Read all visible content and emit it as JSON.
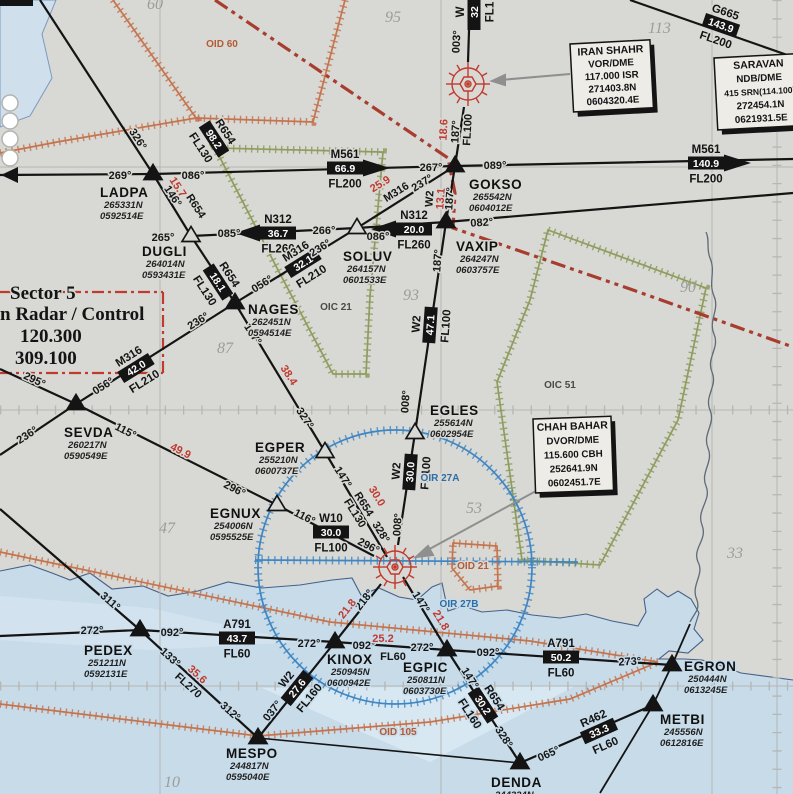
{
  "colors": {
    "land": "#d8d8d4",
    "sea": "#c7dbe9",
    "coast": "#46608c",
    "graticule": "#b6b6b2",
    "ink": "#141414",
    "red": "#c13a2e",
    "boundary_red": "#a83c2e",
    "danger_orange": "#c4744e",
    "area_green": "#8e9c5e",
    "ctr_blue": "#3f86c2",
    "label_blue": "#2e6da4",
    "gray_number": "#9c9c98",
    "pointer_gray": "#8f8f8f"
  },
  "sector_panel": {
    "line1": "Sector 5",
    "line2": "n Radar / Control",
    "freq1": "120.300",
    "freq2": "309.100"
  },
  "navaid_boxes": [
    {
      "id": "iran-shahr",
      "x": 570,
      "y": 44,
      "w": 80,
      "h": 68,
      "rot": -3,
      "lines": [
        "IRAN SHAHR",
        "VOR/DME",
        "117.000 ISR",
        "271403.8N",
        "0604320.4E"
      ]
    },
    {
      "id": "saravan",
      "x": 714,
      "y": 58,
      "w": 88,
      "h": 72,
      "rot": -3,
      "lines": [
        "SARAVAN",
        "NDB/DME",
        "415 SRN(114.100)",
        "272454.1N",
        "0621931.5E"
      ]
    },
    {
      "id": "chah-bahar",
      "x": 533,
      "y": 419,
      "w": 78,
      "h": 74,
      "rot": -2,
      "lines": [
        "CHAH BAHAR",
        "DVOR/DME",
        "115.600 CBH",
        "252641.9N",
        "0602451.7E"
      ]
    }
  ],
  "waypoints": [
    {
      "name": "LADPA",
      "lat": "265331N",
      "lon": "0592514E",
      "x": 153,
      "y": 174,
      "filled": true,
      "lx": 100,
      "ly": 197
    },
    {
      "name": "DUGLI",
      "lat": "264014N",
      "lon": "0593431E",
      "x": 191,
      "y": 236,
      "filled": false,
      "lx": 142,
      "ly": 256
    },
    {
      "name": "SOLUV",
      "lat": "264157N",
      "lon": "0601533E",
      "x": 357,
      "y": 228,
      "filled": false,
      "lx": 343,
      "ly": 261
    },
    {
      "name": "GOKSO",
      "lat": "265542N",
      "lon": "0604012E",
      "x": 455,
      "y": 166,
      "filled": true,
      "lx": 469,
      "ly": 189
    },
    {
      "name": "VAXIP",
      "lat": "264247N",
      "lon": "0603757E",
      "x": 446,
      "y": 222,
      "filled": true,
      "lx": 456,
      "ly": 251
    },
    {
      "name": "NAGES",
      "lat": "262451N",
      "lon": "0594514E",
      "x": 235,
      "y": 303,
      "filled": true,
      "lx": 248,
      "ly": 314
    },
    {
      "name": "SEVDA",
      "lat": "260217N",
      "lon": "0590549E",
      "x": 76,
      "y": 404,
      "filled": true,
      "lx": 64,
      "ly": 437
    },
    {
      "name": "EGLES",
      "lat": "255614N",
      "lon": "0602954E",
      "x": 415,
      "y": 433,
      "filled": false,
      "lx": 430,
      "ly": 415
    },
    {
      "name": "EGPER",
      "lat": "255210N",
      "lon": "0600737E",
      "x": 325,
      "y": 452,
      "filled": false,
      "lx": 255,
      "ly": 452
    },
    {
      "name": "EGNUX",
      "lat": "254006N",
      "lon": "0595525E",
      "x": 277,
      "y": 505,
      "filled": false,
      "lx": 210,
      "ly": 518
    },
    {
      "name": "PEDEX",
      "lat": "251211N",
      "lon": "0592131E",
      "x": 140,
      "y": 630,
      "filled": true,
      "lx": 84,
      "ly": 655
    },
    {
      "name": "KINOX",
      "lat": "250945N",
      "lon": "0600942E",
      "x": 335,
      "y": 642,
      "filled": true,
      "lx": 327,
      "ly": 664
    },
    {
      "name": "EGPIC",
      "lat": "250811N",
      "lon": "0603730E",
      "x": 447,
      "y": 650,
      "filled": true,
      "lx": 403,
      "ly": 672
    },
    {
      "name": "EGRON",
      "lat": "250444N",
      "lon": "0613245E",
      "x": 672,
      "y": 665,
      "filled": true,
      "lx": 684,
      "ly": 671
    },
    {
      "name": "METBI",
      "lat": "245556N",
      "lon": "0612816E",
      "x": 653,
      "y": 705,
      "filled": true,
      "lx": 660,
      "ly": 724
    },
    {
      "name": "MESPO",
      "lat": "244817N",
      "lon": "0595040E",
      "x": 258,
      "y": 738,
      "filled": true,
      "lx": 226,
      "ly": 758
    },
    {
      "name": "DENDA",
      "lat": "244324N",
      "lon": "",
      "x": 520,
      "y": 763,
      "filled": true,
      "lx": 491,
      "ly": 787
    }
  ],
  "airway_boxes": [
    {
      "awy": "M561",
      "dist": "66.9",
      "fl": "FL200",
      "x": 345,
      "y": 168,
      "rot": 0,
      "arrow": "right"
    },
    {
      "awy": "M561",
      "dist": "140.9",
      "fl": "FL200",
      "x": 706,
      "y": 163,
      "rot": 0,
      "arrow": "right"
    },
    {
      "awy": "G665",
      "dist": "143.9",
      "fl": "FL200",
      "x": 721,
      "y": 25,
      "rot": 19,
      "arrow": null
    },
    {
      "awy": "W",
      "dist": "32",
      "fl": "FL1",
      "x": 474,
      "y": 12,
      "rot": -90,
      "arrow": null
    },
    {
      "awy": "R654",
      "dist": "98.2",
      "fl": "FL130",
      "x": 214,
      "y": 139,
      "rot": 57,
      "arrow": null
    },
    {
      "awy": "R654",
      "dist": "18.1",
      "fl": "FL130",
      "x": 218,
      "y": 282,
      "rot": 57,
      "arrow": null
    },
    {
      "awy": "N312",
      "dist": "36.7",
      "fl": "FL260",
      "x": 278,
      "y": 233,
      "rot": 0,
      "arrow": "left"
    },
    {
      "awy": "M316",
      "dist": "32.1",
      "fl": "FL210",
      "x": 303,
      "y": 263,
      "rot": -32,
      "arrow": null
    },
    {
      "awy": "N312",
      "dist": "20.0",
      "fl": "FL260",
      "x": 414,
      "y": 229,
      "rot": 0,
      "arrow": "left"
    },
    {
      "awy": "M316",
      "dist": "42.0",
      "fl": "FL210",
      "x": 136,
      "y": 368,
      "rot": -32,
      "arrow": null
    },
    {
      "awy": "W2",
      "dist": "47.1",
      "fl": "FL100",
      "x": 430,
      "y": 325,
      "rot": -86,
      "arrow": null
    },
    {
      "awy": "W2",
      "dist": "30.0",
      "fl": "FL100",
      "x": 410,
      "y": 472,
      "rot": -86,
      "arrow": null
    },
    {
      "awy": "W10",
      "dist": "30.0",
      "fl": "FL100",
      "x": 331,
      "y": 532,
      "rot": 0,
      "arrow": null
    },
    {
      "awy": "W2",
      "dist": "27.6",
      "fl": "FL160",
      "x": 297,
      "y": 688,
      "rot": -51,
      "arrow": null
    },
    {
      "awy": "R654",
      "dist": "30.2",
      "fl": "FL160",
      "x": 483,
      "y": 705,
      "rot": 57,
      "arrow": null
    },
    {
      "awy": "A791",
      "dist": "43.7",
      "fl": "FL60",
      "x": 237,
      "y": 638,
      "rot": 0,
      "arrow": null
    },
    {
      "awy": "A791",
      "dist": "50.2",
      "fl": "FL60",
      "x": 561,
      "y": 657,
      "rot": 0,
      "arrow": null
    },
    {
      "awy": "R462",
      "dist": "33.3",
      "fl": "FL60",
      "x": 599,
      "y": 731,
      "rot": -24,
      "arrow": null
    }
  ],
  "bearing_labels": [
    {
      "t": "269°",
      "x": 120,
      "y": 179,
      "r": 0
    },
    {
      "t": "086°",
      "x": 193,
      "y": 179,
      "r": 0
    },
    {
      "t": "326°",
      "x": 135,
      "y": 141,
      "r": 57
    },
    {
      "t": "146°",
      "x": 170,
      "y": 198,
      "r": 57
    },
    {
      "t": "265°",
      "x": 163,
      "y": 241,
      "r": 0
    },
    {
      "t": "085°",
      "x": 229,
      "y": 237,
      "r": 0
    },
    {
      "t": "266°",
      "x": 324,
      "y": 234,
      "r": 0
    },
    {
      "t": "086°",
      "x": 378,
      "y": 240,
      "r": 0
    },
    {
      "t": "237°",
      "x": 424,
      "y": 186,
      "r": -32
    },
    {
      "t": "267°",
      "x": 431,
      "y": 171,
      "r": 0
    },
    {
      "t": "089°",
      "x": 495,
      "y": 169,
      "r": 0
    },
    {
      "t": "003°",
      "x": 460,
      "y": 42,
      "r": -87
    },
    {
      "t": "187°",
      "x": 459,
      "y": 132,
      "r": -87
    },
    {
      "t": "187°",
      "x": 453,
      "y": 199,
      "r": -86
    },
    {
      "t": "082°",
      "x": 482,
      "y": 226,
      "r": -4
    },
    {
      "t": "187°",
      "x": 441,
      "y": 261,
      "r": -86
    },
    {
      "t": "056°",
      "x": 264,
      "y": 287,
      "r": -32
    },
    {
      "t": "236°",
      "x": 322,
      "y": 251,
      "r": -32
    },
    {
      "t": "147°",
      "x": 250,
      "y": 336,
      "r": 57
    },
    {
      "t": "327°",
      "x": 302,
      "y": 420,
      "r": 57
    },
    {
      "t": "236°",
      "x": 200,
      "y": 324,
      "r": -32
    },
    {
      "t": "056°",
      "x": 105,
      "y": 389,
      "r": -32
    },
    {
      "t": "295°",
      "x": 33,
      "y": 383,
      "r": 25
    },
    {
      "t": "236°",
      "x": 29,
      "y": 438,
      "r": -33
    },
    {
      "t": "115°",
      "x": 124,
      "y": 434,
      "r": 27
    },
    {
      "t": "296°",
      "x": 233,
      "y": 492,
      "r": 27
    },
    {
      "t": "116°",
      "x": 303,
      "y": 520,
      "r": 27
    },
    {
      "t": "296°",
      "x": 367,
      "y": 549,
      "r": 27
    },
    {
      "t": "147°",
      "x": 340,
      "y": 479,
      "r": 58
    },
    {
      "t": "328°",
      "x": 378,
      "y": 534,
      "r": 58
    },
    {
      "t": "008°",
      "x": 409,
      "y": 402,
      "r": -86
    },
    {
      "t": "008°",
      "x": 401,
      "y": 525,
      "r": -86
    },
    {
      "t": "218°",
      "x": 367,
      "y": 602,
      "r": -52
    },
    {
      "t": "147°",
      "x": 418,
      "y": 604,
      "r": 58
    },
    {
      "t": "311°",
      "x": 108,
      "y": 604,
      "r": 41
    },
    {
      "t": "272°",
      "x": 92,
      "y": 634,
      "r": 0
    },
    {
      "t": "092°",
      "x": 172,
      "y": 636,
      "r": 0
    },
    {
      "t": "133°",
      "x": 168,
      "y": 660,
      "r": 42
    },
    {
      "t": "312°",
      "x": 228,
      "y": 714,
      "r": 42
    },
    {
      "t": "037°",
      "x": 275,
      "y": 713,
      "r": -51
    },
    {
      "t": "272°",
      "x": 309,
      "y": 647,
      "r": 0
    },
    {
      "t": "092°",
      "x": 364,
      "y": 649,
      "r": 0
    },
    {
      "t": "272°",
      "x": 422,
      "y": 651,
      "r": 0
    },
    {
      "t": "092°",
      "x": 488,
      "y": 656,
      "r": 0
    },
    {
      "t": "273°",
      "x": 630,
      "y": 665,
      "r": -3
    },
    {
      "t": "328°",
      "x": 501,
      "y": 739,
      "r": 57
    },
    {
      "t": "147°",
      "x": 467,
      "y": 680,
      "r": 58
    },
    {
      "t": "065°",
      "x": 550,
      "y": 757,
      "r": -24
    }
  ],
  "red_labels": [
    {
      "t": "15.7",
      "x": 175,
      "y": 189,
      "r": 57
    },
    {
      "t": "18.6",
      "x": 447,
      "y": 130,
      "r": -87
    },
    {
      "t": "13.1",
      "x": 444,
      "y": 199,
      "r": -86
    },
    {
      "t": "25.9",
      "x": 382,
      "y": 187,
      "r": -32
    },
    {
      "t": "38.4",
      "x": 286,
      "y": 377,
      "r": 57
    },
    {
      "t": "49.9",
      "x": 179,
      "y": 454,
      "r": 27
    },
    {
      "t": "30.0",
      "x": 374,
      "y": 498,
      "r": 58
    },
    {
      "t": "21.8",
      "x": 350,
      "y": 611,
      "r": -52
    },
    {
      "t": "21.8",
      "x": 438,
      "y": 622,
      "r": 58
    },
    {
      "t": "25.2",
      "x": 383,
      "y": 642,
      "r": 0
    },
    {
      "t": "35.6",
      "x": 195,
      "y": 677,
      "r": 42
    }
  ],
  "plain_labels": [
    {
      "t": "W2",
      "x": 433,
      "y": 199,
      "r": -86
    },
    {
      "t": "M316",
      "x": 398,
      "y": 195,
      "r": -32
    },
    {
      "t": "R654",
      "x": 193,
      "y": 208,
      "r": 57
    },
    {
      "t": "R654",
      "x": 361,
      "y": 506,
      "r": 58
    },
    {
      "t": "FL130",
      "x": 352,
      "y": 515,
      "r": 58
    },
    {
      "t": "FL270",
      "x": 186,
      "y": 688,
      "r": 42
    },
    {
      "t": "FL60",
      "x": 393,
      "y": 660,
      "r": 0
    },
    {
      "t": "FL100",
      "x": 471,
      "y": 130,
      "r": -87
    }
  ],
  "area_labels": [
    {
      "t": "OID 60",
      "x": 222,
      "y": 47,
      "c": "orange"
    },
    {
      "t": "OIC 21",
      "x": 336,
      "y": 310,
      "c": "dark"
    },
    {
      "t": "OIC 51",
      "x": 560,
      "y": 388,
      "c": "dark"
    },
    {
      "t": "OIR 27A",
      "x": 440,
      "y": 481,
      "c": "blue"
    },
    {
      "t": "OIR 27B",
      "x": 459,
      "y": 607,
      "c": "blue"
    },
    {
      "t": "OID 21",
      "x": 473,
      "y": 569,
      "c": "orange"
    },
    {
      "t": "OID 105",
      "x": 398,
      "y": 735,
      "c": "orange"
    }
  ],
  "grid_numbers": [
    {
      "t": "60",
      "x": 147,
      "y": 9
    },
    {
      "t": "95",
      "x": 385,
      "y": 22
    },
    {
      "t": "113",
      "x": 648,
      "y": 33
    },
    {
      "t": "90",
      "x": 680,
      "y": 292
    },
    {
      "t": "93",
      "x": 403,
      "y": 300
    },
    {
      "t": "87",
      "x": 217,
      "y": 353
    },
    {
      "t": "53",
      "x": 466,
      "y": 513
    },
    {
      "t": "47",
      "x": 159,
      "y": 533
    },
    {
      "t": "33",
      "x": 727,
      "y": 558
    },
    {
      "t": "10",
      "x": 164,
      "y": 787
    }
  ]
}
